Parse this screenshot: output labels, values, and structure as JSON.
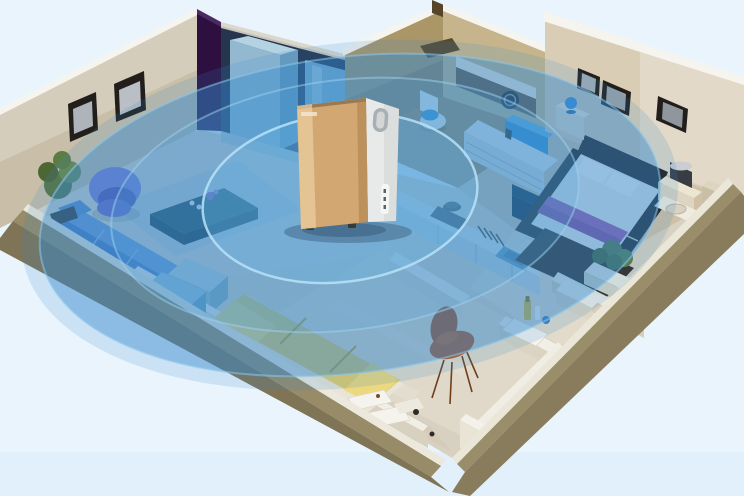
{
  "meta": {
    "type": "3d-isometric-apartment-render",
    "description": "Isometric cutaway apartment 3D render with a champagne-gold air purifier standing in the hallway and translucent blue concentric ellipses visualizing its whole-home coverage area"
  },
  "palette": {
    "bg": "#e9f4fd",
    "bgBand": "#e1effa",
    "floor": "#d8d1c2",
    "floorLiving": "#dcd6cb",
    "floorWarm": "#cfc0a6",
    "floorCream": "#e2dbcb",
    "floorStrip": "#d5cbb8",
    "floorTan": "#a18a5c",
    "wallCream": "#c9bfa9",
    "wallCreamL": "#d9cdb6",
    "wallCap": "#f6f4ee",
    "wallTan": "#ab9668",
    "wallTanL": "#c6b58c",
    "khakiTop": "#978b68",
    "khakiFace": "#7f7456",
    "khakiFaceR": "#887c5c",
    "whiteSliver": "#ece8dc",
    "purplePanel": "#2e1040",
    "coverage": "#3489cc",
    "coverageMid": "#4da2da",
    "coverageInner": "#6ab6e6",
    "coverageRim": "#b8e2f8",
    "gold": "#d3a772",
    "goldLight": "#ecd0a2",
    "goldDark": "#a87c46",
    "deviceWhite": "#e8eae9",
    "deviceTop": "#f0f2f1",
    "sofa": "#6e99d6",
    "sofaDark": "#4a7ac0",
    "chairPurple": "#847cd6",
    "tableTeal": "#274653",
    "rugGrey": "#c6cbd1",
    "bedYellow": "#e2cb6b",
    "runner": "#a558aa",
    "bedFrame": "#241d17",
    "mattress": "#f2f0ea",
    "navy": "#13293f",
    "orange": "#b5561f",
    "plant": "#5a7540",
    "counterBlue": "#d7e3e8",
    "cabinetBlue": "#93b9d0",
    "basinBlue": "#2f8cd2",
    "frameDark": "#221e1b",
    "rugDark": "#35291f"
  },
  "scene": {
    "coverage": {
      "shape": "concentric-ellipses",
      "ring_count": 3,
      "color": "#3489cc",
      "rim_color": "#b8e2f8"
    },
    "purifier": {
      "name": "air-purifier",
      "finish_front": "#d3a772",
      "finish_side": "#e8eae9",
      "position": "hallway-center"
    },
    "rooms": [
      {
        "name": "living-room",
        "furniture": [
          "blue-sofa",
          "purple-tub-chair",
          "teal-coffee-table",
          "grey-rug",
          "potted-plant",
          "wall-frames"
        ]
      },
      {
        "name": "hallway",
        "furniture": [
          "wardrobe-cabinets",
          "purple-wall-panel"
        ]
      },
      {
        "name": "bathroom",
        "furniture": [
          "toilet",
          "vanity-counter",
          "washing-machine",
          "blue-basin",
          "shower-mat"
        ]
      },
      {
        "name": "master-bedroom",
        "furniture": [
          "double-bed",
          "purple-runner",
          "nightstand-lamps",
          "dresser",
          "wall-frames",
          "dark-rug",
          "planter-shrubs"
        ]
      },
      {
        "name": "kitchen",
        "furniture": [
          "counter-run",
          "stove-pot",
          "dish-rack",
          "sink",
          "navy-bar-counter"
        ]
      },
      {
        "name": "second-bedroom",
        "furniture": [
          "yellow-bed",
          "blue-dresser"
        ]
      },
      {
        "name": "study-entry",
        "furniture": [
          "orange-chair",
          "floor-papers",
          "serving-tray"
        ]
      }
    ]
  }
}
